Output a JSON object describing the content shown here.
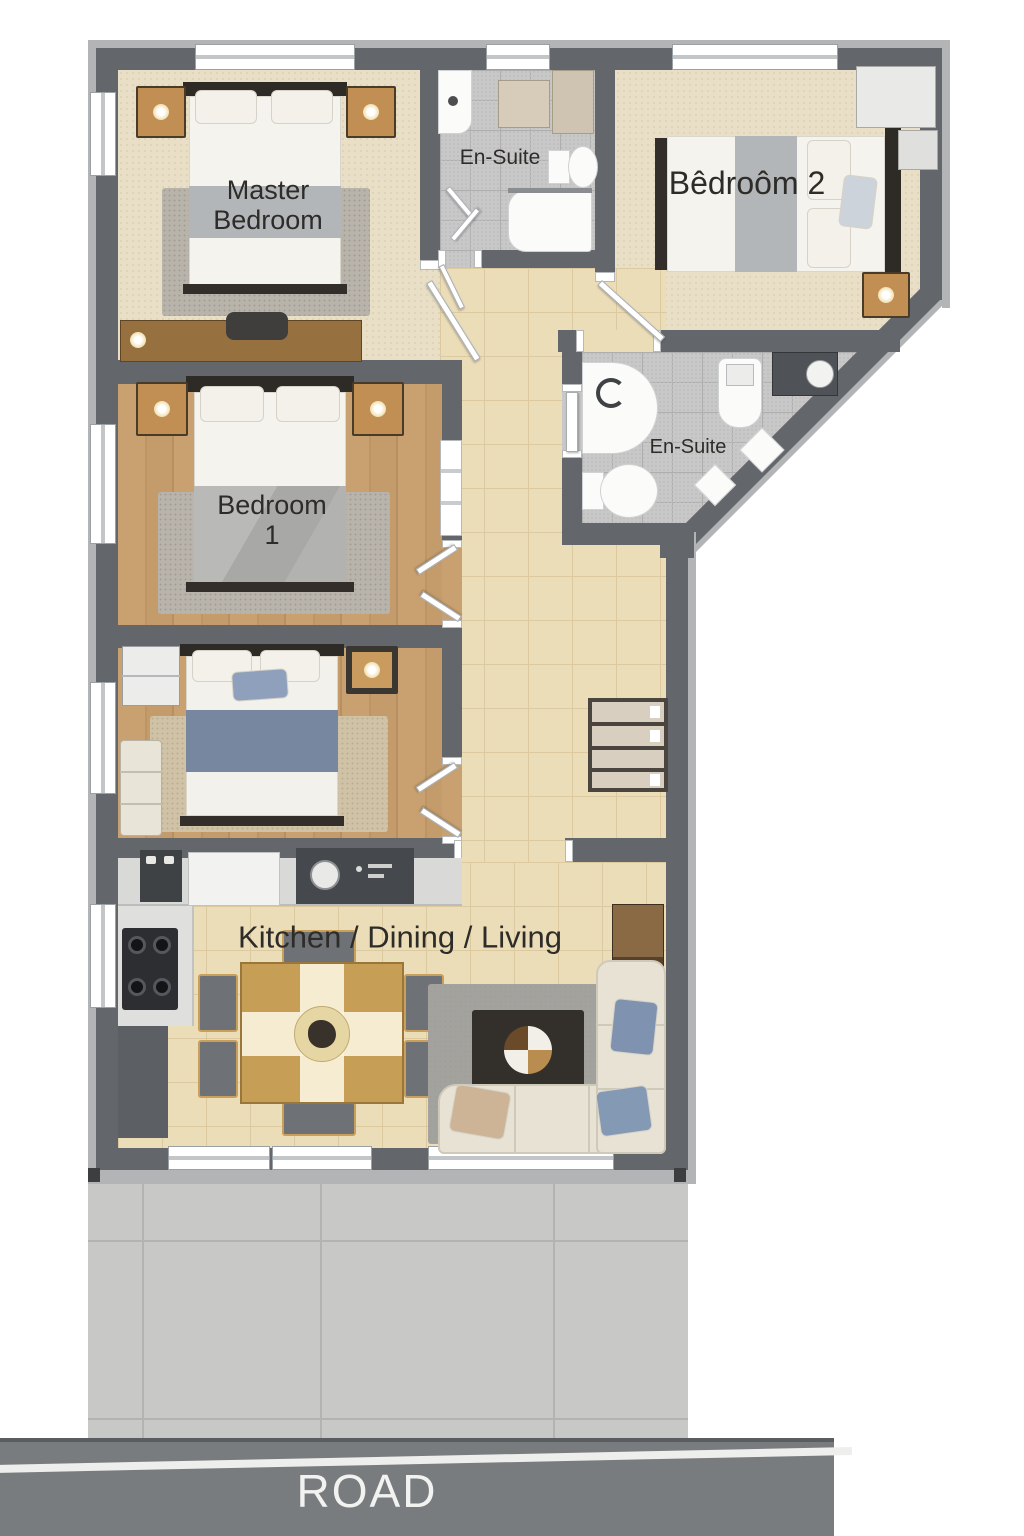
{
  "plan_title": "floor-plan",
  "labels": {
    "master_line1": "Master",
    "master_line2": "Bedroom",
    "ensuite_top": "En-Suite",
    "bedroom2": "Bêdroôm 2",
    "ensuite_mid": "En-Suite",
    "bedroom1_line1": "Bedroom",
    "bedroom1_line2": "1",
    "kitchen": "Kitchen / Dining / Living",
    "road": "ROAD"
  },
  "rooms": [
    {
      "id": "master-bedroom",
      "label": "Master Bedroom",
      "floor": "beige-carpet",
      "furniture": [
        "double-bed",
        "nightstand-left",
        "nightstand-right",
        "table-lamps",
        "area-rug",
        "dresser",
        "chair"
      ]
    },
    {
      "id": "ensuite-top",
      "label": "En-Suite",
      "floor": "gray-tile",
      "furniture": [
        "corner-sink",
        "storage-cabinets",
        "toilet",
        "shower",
        "shower-glass-door"
      ]
    },
    {
      "id": "bedroom-2",
      "label": "Bêdroôm 2",
      "floor": "beige-carpet",
      "furniture": [
        "double-bed",
        "wardrobe",
        "nightstand",
        "table-lamp"
      ]
    },
    {
      "id": "ensuite-mid",
      "label": "En-Suite",
      "floor": "gray-tile",
      "furniture": [
        "corner-shower",
        "toilet",
        "shower-column",
        "vanity-sink",
        "side-stools"
      ]
    },
    {
      "id": "bedroom-1",
      "label": "Bedroom 1",
      "floor": "wood",
      "furniture": [
        "double-bed",
        "nightstand-left",
        "nightstand-right",
        "table-lamps",
        "area-rug",
        "double-door"
      ]
    },
    {
      "id": "bedroom-3",
      "label": "",
      "floor": "wood",
      "furniture": [
        "double-bed-blue-duvet",
        "nightstand",
        "cabinet",
        "bench",
        "area-rug",
        "double-door"
      ]
    },
    {
      "id": "kitchen-dining-living",
      "label": "Kitchen / Dining / Living",
      "floor": "beige-tile",
      "furniture": [
        "kitchen-counter",
        "sink-unit",
        "cooktop",
        "base-cabinet",
        "dining-table",
        "six-chairs",
        "living-rug",
        "coffee-table",
        "l-shaped-sofa",
        "throw-pillows",
        "tv-cabinet"
      ]
    },
    {
      "id": "hallway",
      "label": "",
      "floor": "beige-tile",
      "furniture": [
        "shelf-unit",
        "interior-doors"
      ]
    }
  ],
  "exterior": {
    "driveway": "concrete-paving",
    "road_label": "ROAD"
  },
  "colors": {
    "wall_dark": "#63666b",
    "wall_outer": "#b2b4b6",
    "carpet_beige": "#e8dfc6",
    "wood_floor": "#c9a170",
    "tile_beige": "#ecddb9",
    "tile_gray": "#c8c8c8",
    "driveway_concrete": "#c8c8c6",
    "road_gray": "#797c7f",
    "road_text": "#f2f2f0",
    "label_text": "#2e2c28",
    "bed_linen": "#f5f3ee",
    "bed_band_gray": "#b3b6b9",
    "bed_band_denim": "#76879f",
    "nightstand_wood": "#c18e54",
    "sofa_cream": "#e7e2d4",
    "pillow_blue": "#8499b4",
    "pillow_tan": "#cdb496"
  }
}
